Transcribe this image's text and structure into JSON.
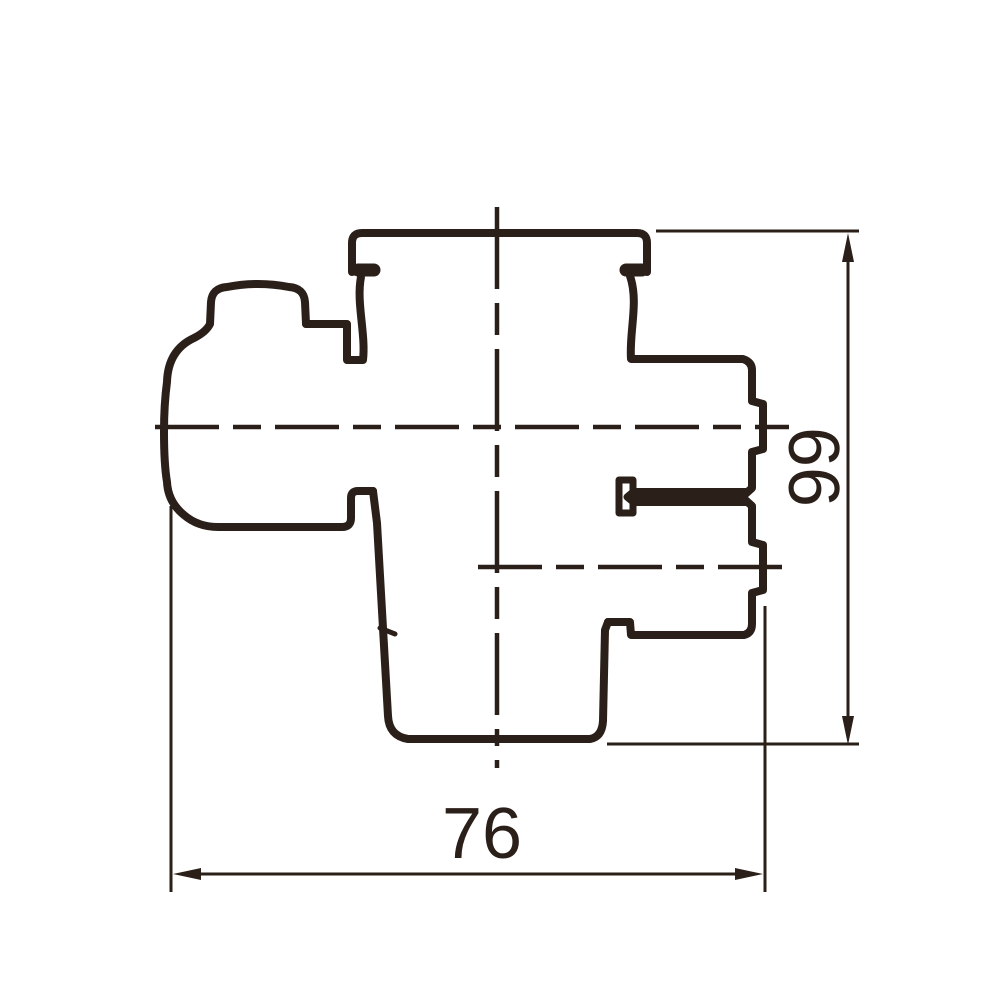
{
  "drawing": {
    "type": "technical-profile-drawing",
    "line_color": "#2b1f1a",
    "background_color": "#ffffff",
    "dimensions": {
      "width": {
        "value": "76",
        "orientation": "horizontal",
        "position": "bottom"
      },
      "height": {
        "value": "66",
        "orientation": "vertical-rotated-90cw",
        "position": "right"
      }
    }
  }
}
